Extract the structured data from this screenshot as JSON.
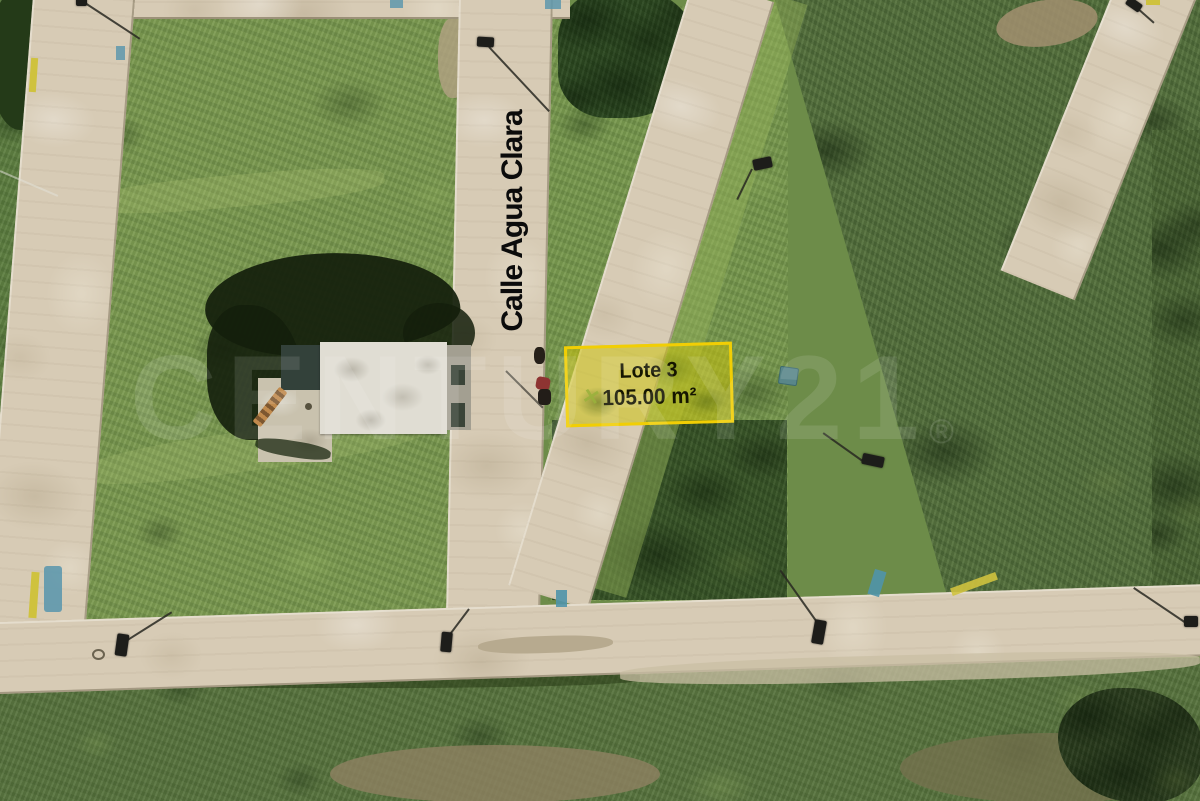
{
  "street": {
    "label": "Calle Agua Clara"
  },
  "highlighted_lot": {
    "name": "Lote 3",
    "area": "105.00 m²",
    "border_color": "#F1CE04",
    "fill_color": "rgba(205,195,10,0.52)",
    "label_color": "#151500"
  },
  "watermark": {
    "text": "CENTURY21",
    "registered_mark": "®"
  },
  "scene": {
    "type": "aerial-drone-photo-of-land-lots",
    "features": {
      "roads": [
        "top-cross-street",
        "left-street",
        "central-street-calle-agua-clara",
        "right-street",
        "far-right-street",
        "bottom-cross-street"
      ],
      "building": "unfinished-house-white-roof",
      "vehicle": "motorcycle-with-rider",
      "street_lamp_count": 9
    },
    "palette": {
      "pavement": "#D7CBB5",
      "grass_light": "#7D9B52",
      "grass_dark": "#3A5629",
      "scrub_olive": "#587440",
      "tree_shadow": "#141F0C",
      "roof_white": "#E0DDD3",
      "dirt": "#A28F70",
      "curb_blue": "#5E98AD",
      "curb_yellow": "#CFC23E"
    }
  }
}
